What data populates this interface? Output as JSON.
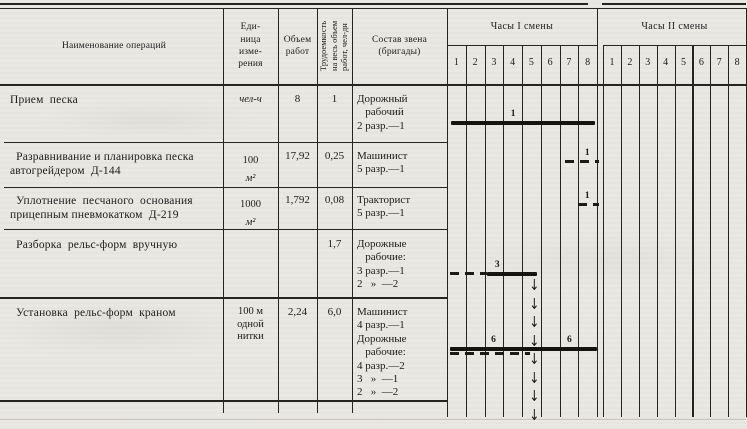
{
  "document": {
    "kind": "scanned work-schedule table (road construction operations, shift hour chart)"
  },
  "table": {
    "headers": {
      "name": "Наименование операций",
      "unit": "Еди-\nница\nизме-\nрения",
      "volume": "Объем\nработ",
      "labor": "Трудоемкость\nна весь объем\nработ, чел-дн",
      "crew": "Состав звена\n(бригады)",
      "shift1": "Часы I смены",
      "shift2": "Часы II смены",
      "hours": [
        "1",
        "2",
        "3",
        "4",
        "5",
        "6",
        "7",
        "8"
      ]
    },
    "rows": [
      {
        "name": "Прием  песка",
        "unit_value": "",
        "unit_symbol": "чел-ч",
        "volume": "8",
        "labor": "1",
        "crew": "Дорожный\n   рабочий\n2 разр.—1"
      },
      {
        "name": "  Разравнивание и планировка песка\nавтогрейдером  Д-144",
        "unit_value": "100",
        "unit_symbol": "м²",
        "volume": "17,92",
        "labor": "0,25",
        "crew": "Машинист\n5 разр.—1"
      },
      {
        "name": "  Уплотнение  песчаного  основания\nприцепным пневмокатком  Д-219",
        "unit_value": "1000",
        "unit_symbol": "м²",
        "volume": "1,792",
        "labor": "0,08",
        "crew": "Тракторист\n5 разр.—1"
      },
      {
        "name": "  Разборка  рельс-форм  вручную",
        "unit_value": "",
        "unit_symbol": "",
        "volume": "",
        "labor": "1,7",
        "crew": "Дорожные\n   рабочие:\n3 разр.—1\n2   »  —2"
      },
      {
        "name": "  Установка  рельс-форм  краном",
        "unit_value": "100 м\nодной\nнитки",
        "unit_symbol": "",
        "volume": "2,24",
        "labor": "6,0",
        "crew": "Машинист\n4 разр.—1\nДорожные\n   рабочие:\n4 разр.—2\n3   »  —1\n2   »  —2"
      }
    ]
  },
  "chart_data": {
    "type": "gantt",
    "title": "Hour schedule of operations",
    "x_groups": [
      "Часы I смены",
      "Часы II смены"
    ],
    "hours_per_shift": 8,
    "units_note": "bar start/end measured in shift-I hours (0–8); all work occurs in shift I",
    "bars": [
      {
        "row": 0,
        "operation": "Прием песка",
        "start": 0.2,
        "end": 7.9,
        "style": "solid",
        "labels": [
          {
            "text": "1",
            "at": 3.4
          }
        ]
      },
      {
        "row": 1,
        "operation": "Разравнивание и планировка песка автогрейдером Д-144",
        "start": 6.3,
        "end": 8.1,
        "style": "dashed",
        "labels": [
          {
            "text": "1",
            "at": 7.35
          }
        ]
      },
      {
        "row": 2,
        "operation": "Уплотнение песчаного основания прицепным пневмокатком Д-219",
        "start": 7.0,
        "end": 8.1,
        "style": "dashed",
        "labels": [
          {
            "text": "1",
            "at": 7.35
          }
        ]
      },
      {
        "row": 3,
        "operation": "Разборка рельс-форм вручную",
        "start": 0.15,
        "end": 2.15,
        "style": "dashed",
        "labels": []
      },
      {
        "row": 3,
        "operation": "Разборка рельс-форм вручную",
        "start": 2.15,
        "end": 4.8,
        "style": "solid",
        "labels": [
          {
            "text": "3",
            "at": 2.55
          }
        ]
      },
      {
        "row": 4,
        "operation": "Установка рельс-форм краном",
        "start": 0.15,
        "end": 8.0,
        "style": "solid",
        "labels": [
          {
            "text": "6",
            "at": 2.35
          },
          {
            "text": "6",
            "at": 6.4
          }
        ]
      },
      {
        "row": 4,
        "operation": "Установка рельс-форм краном (второе звено)",
        "start": 0.15,
        "end": 4.4,
        "style": "dashed",
        "dy": 5,
        "labels": []
      }
    ],
    "flow_arrow": {
      "hour": 4.6,
      "from_row": 3,
      "to_bottom": true,
      "direction": "down"
    }
  }
}
